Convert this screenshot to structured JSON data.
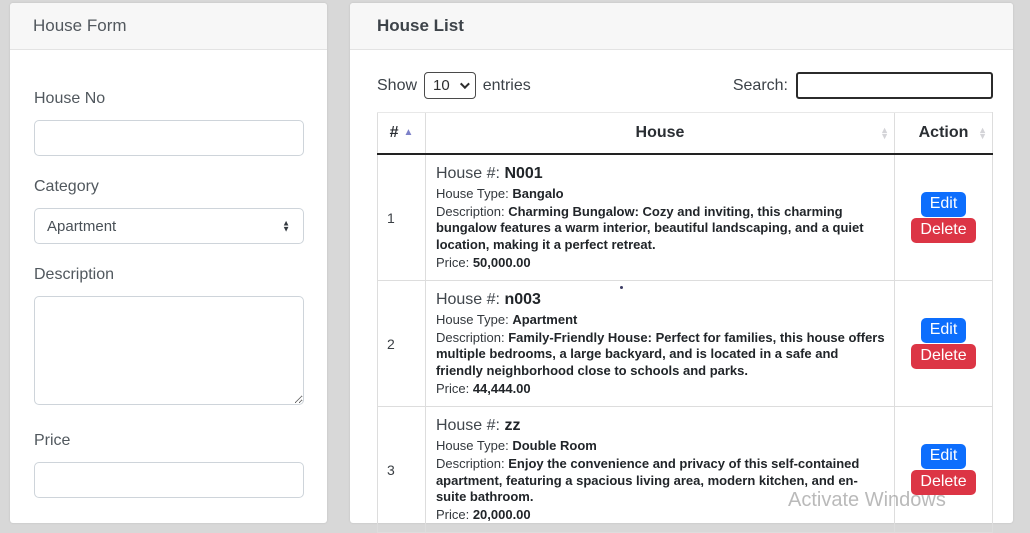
{
  "form_panel": {
    "title": "House Form",
    "house_no": {
      "label": "House No",
      "value": ""
    },
    "category": {
      "label": "Category",
      "value": "Apartment"
    },
    "description": {
      "label": "Description",
      "value": ""
    },
    "price": {
      "label": "Price",
      "value": ""
    }
  },
  "list_panel": {
    "title": "House List",
    "show_label": "Show",
    "page_length": "10",
    "entries_label": "entries",
    "search_label": "Search:",
    "search_value": "",
    "table": {
      "columns": [
        {
          "label": "#",
          "sort": "asc"
        },
        {
          "label": "House",
          "sort": "none"
        },
        {
          "label": "Action",
          "sort": "none"
        }
      ],
      "field_labels": {
        "house_no": "House #:",
        "house_type": "House Type:",
        "description": "Description:",
        "price": "Price:"
      },
      "actions": {
        "edit": "Edit",
        "delete": "Delete"
      },
      "rows": [
        {
          "index": "1",
          "house_no": "N001",
          "house_type": "Bangalo",
          "description": "Charming Bungalow: Cozy and inviting, this charming bungalow features a warm interior, beautiful landscaping, and a quiet location, making it a perfect retreat.",
          "price": "50,000.00"
        },
        {
          "index": "2",
          "house_no": "n003",
          "house_type": "Apartment",
          "description": "Family-Friendly House: Perfect for families, this house offers multiple bedrooms, a large backyard, and is located in a safe and friendly neighborhood close to schools and parks.",
          "price": "44,444.00"
        },
        {
          "index": "3",
          "house_no": "zz",
          "house_type": "Double Room",
          "description": "Enjoy the convenience and privacy of this self-contained apartment, featuring a spacious living area, modern kitchen, and en-suite bathroom.",
          "price": "20,000.00"
        }
      ]
    }
  },
  "watermark": {
    "text": "Activate Windows"
  },
  "colors": {
    "edit_button": "#0d6efd",
    "delete_button": "#dc3545",
    "sort_active": "#7d81c9",
    "page_background": "#d8d8d8"
  }
}
